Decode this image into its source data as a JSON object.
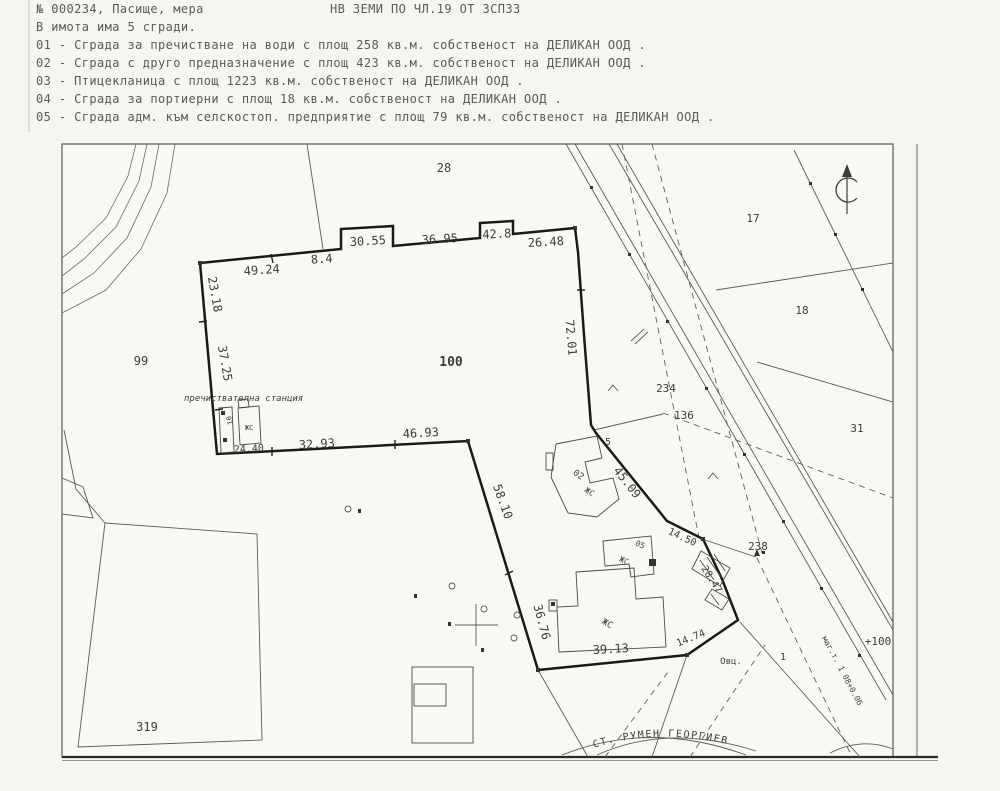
{
  "colors": {
    "paper": "#f5f5f2",
    "ink_faded": "#5a5a5a",
    "ink_map": "#3d3d3d",
    "boundary": "#1a1a1a"
  },
  "header": {
    "doc_number_line": "№ 000234, Пасище, мера",
    "doc_type_line": "НВ ЗЕМИ ПО ЧЛ.19 ОТ ЗСПЗЗ",
    "buildings_intro": "В имота има 5 сгради.",
    "building_lines": [
      "01 - Сграда за пречистване на води с площ 258 кв.м.  собственост на ДЕЛИКАН ООД .",
      "02 - Сграда с друго предназначение с площ 423 кв.м.  собственост на ДЕЛИКАН ООД .",
      "03 - Птицекланица с площ 1223 кв.м.  собственост на ДЕЛИКАН ООД .",
      "04 - Сграда за портиерни с площ 18 кв.м.  собственост на ДЕЛИКАН ООД .",
      "05 - Сграда адм. към селскостоп. предприятие с площ 79 кв.м.  собственост на ДЕЛИКАН ООД ."
    ]
  },
  "map": {
    "parcels": {
      "p28": "28",
      "p99": "99",
      "p100": "100",
      "p17": "17",
      "p18": "18",
      "p31": "31",
      "p319": "319",
      "p234": "234",
      "p136": "136",
      "p238": "238",
      "p1": "1",
      "p5": "5"
    },
    "markers": {
      "station_plus": "+100",
      "ovc": "Овц.",
      "road_station": "маг.т. 1 08+0.06"
    },
    "station_label": "пречиствателна станция",
    "road_name": "СТ. РУМЕН ГЕОРГИЕВ",
    "measurements": {
      "m1": "49.24",
      "m2": "8.4",
      "m3": "30.55",
      "m4": "36.95",
      "m5": "42.8",
      "m6": "26.48",
      "m7": "23.18",
      "m8": "37.25",
      "m9": "72.01",
      "m10": "32.93",
      "m11": "46.93",
      "m12": "24.40",
      "m13": "58.10",
      "m14": "36.76",
      "m15": "45.09",
      "m16": "14.50",
      "m17": "28.47",
      "m18": "14.74",
      "m19": "39.13"
    },
    "building_labels": {
      "b01": "01",
      "b02": "02",
      "b05": "05",
      "zhs": "ЖС"
    }
  }
}
